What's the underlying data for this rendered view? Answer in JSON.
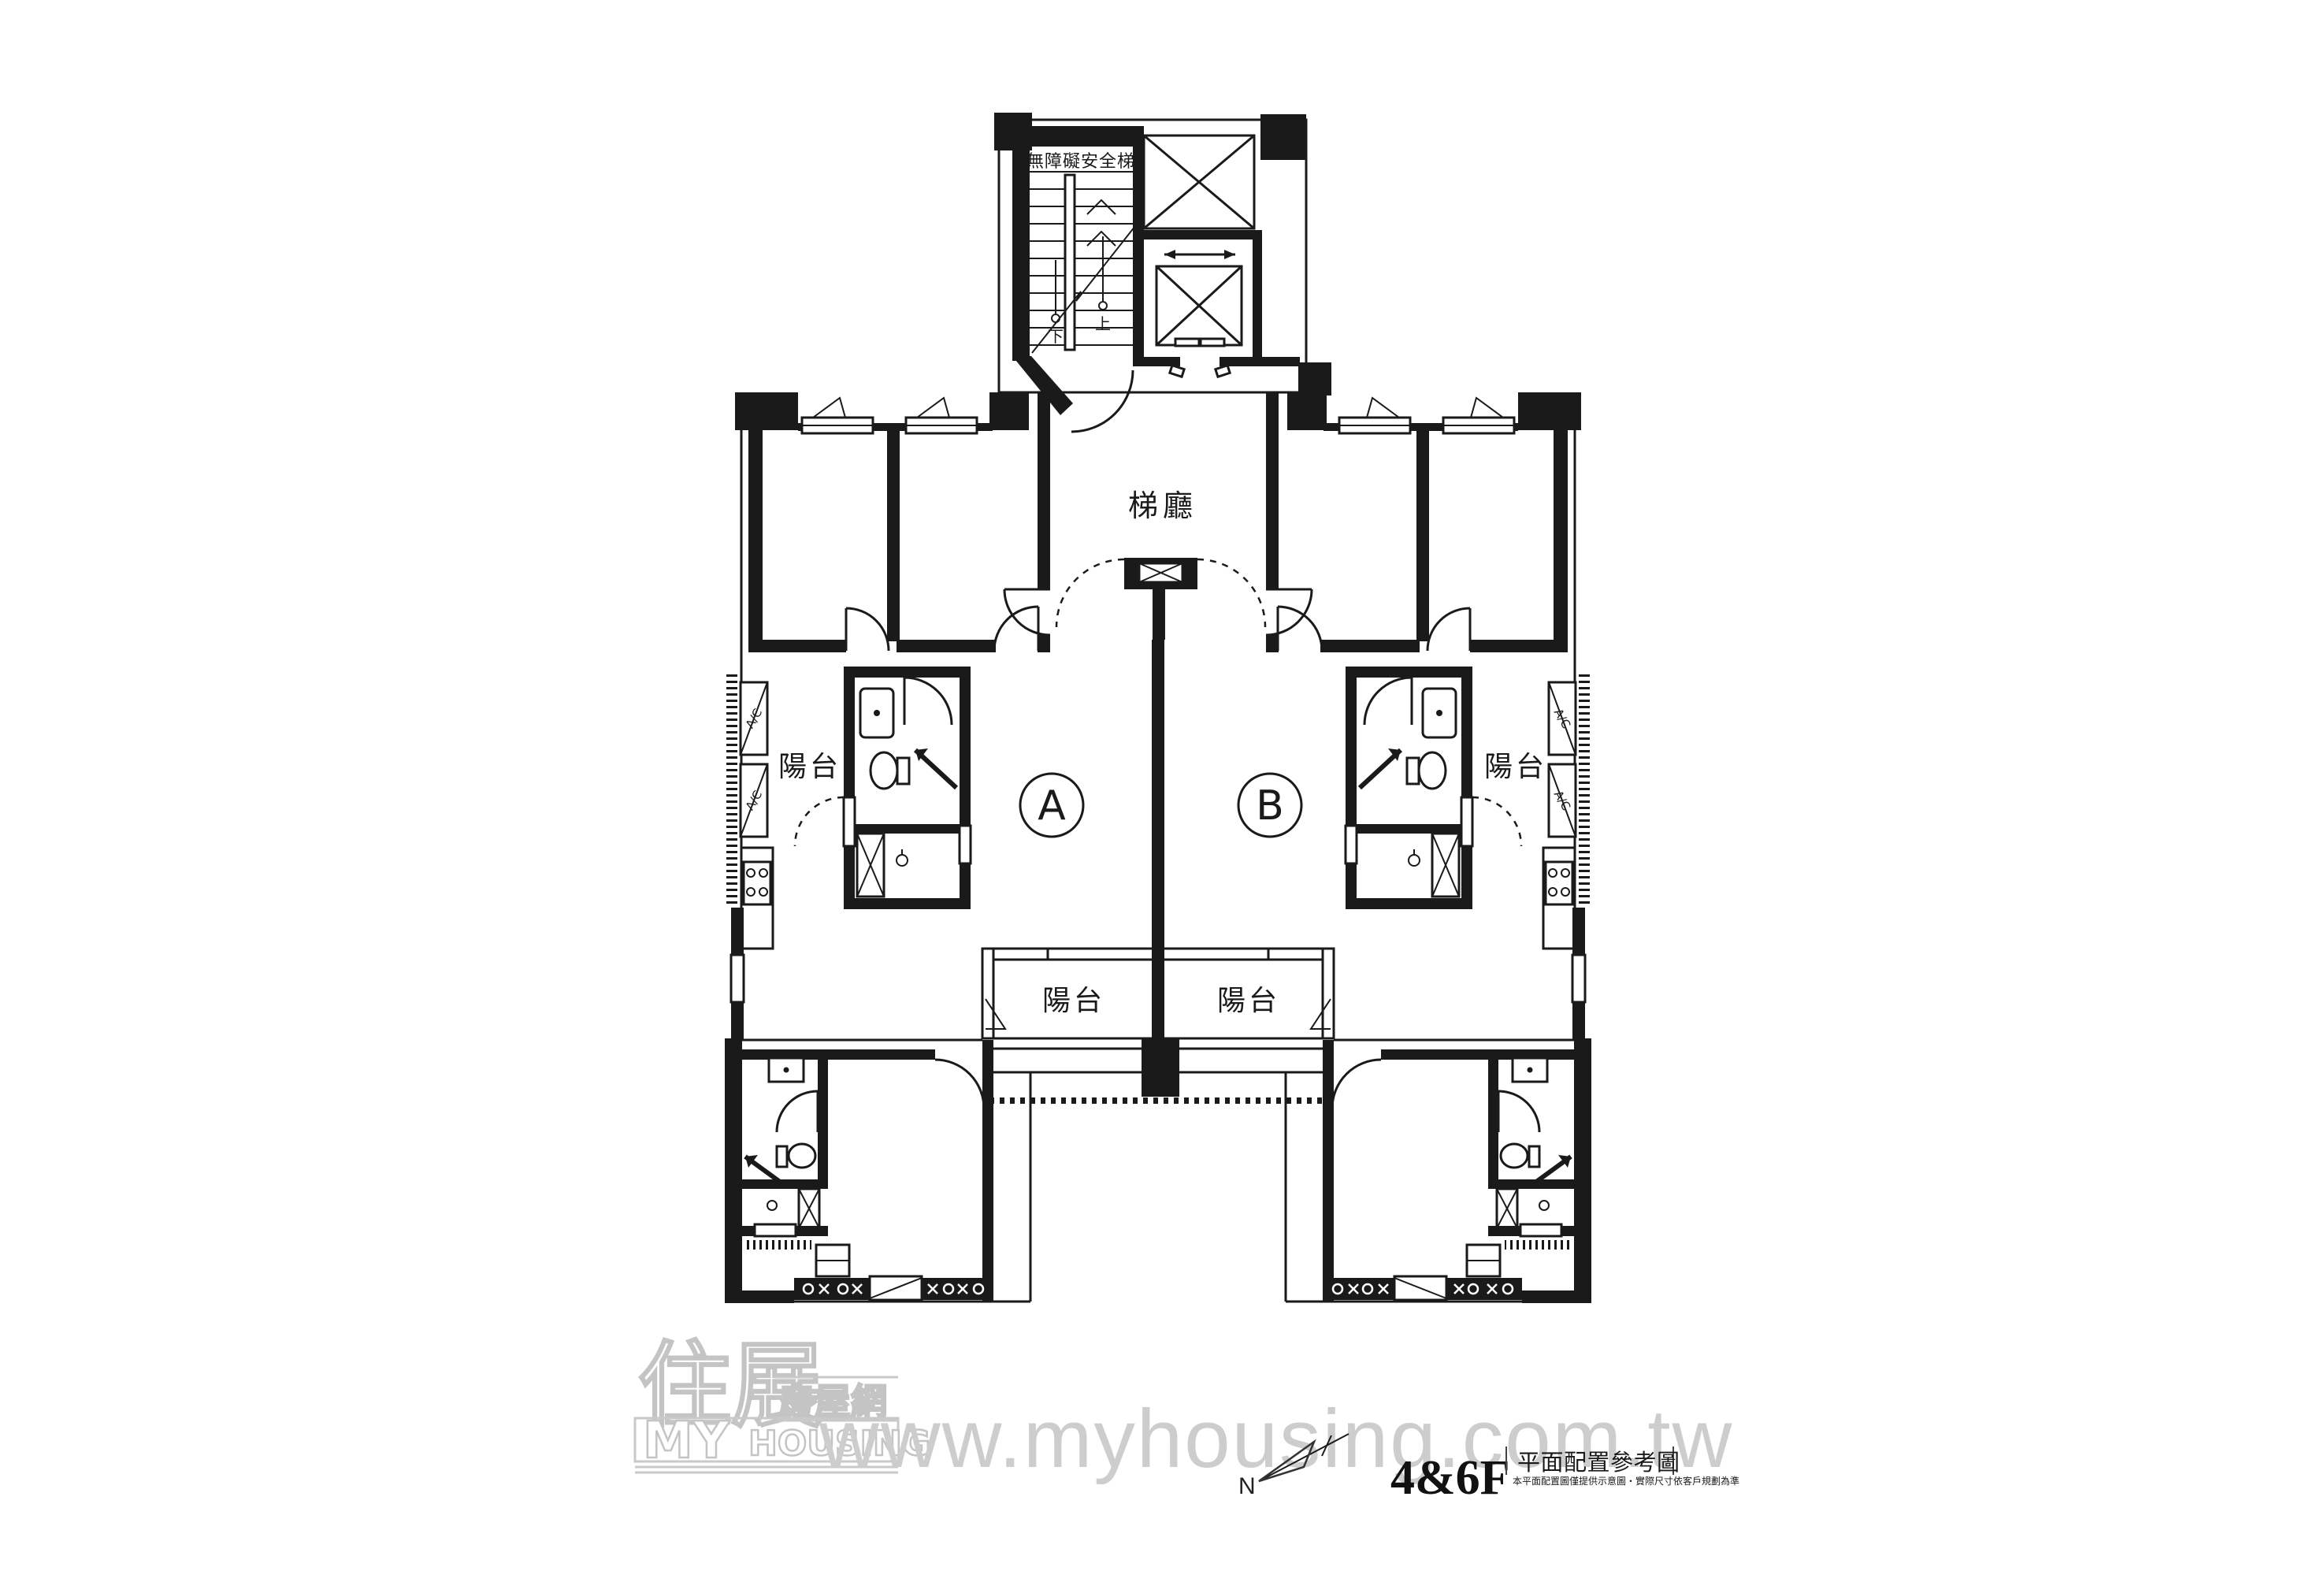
{
  "plan": {
    "stair": {
      "label": "無障礙安全梯",
      "up": "上",
      "down": "下"
    },
    "lobby": {
      "label": "梯廳"
    },
    "units": {
      "a": "A",
      "b": "B"
    },
    "balconies": {
      "left": "陽台",
      "right": "陽台",
      "bottom_left": "陽台",
      "bottom_right": "陽台"
    },
    "ac": "A/C"
  },
  "footer": {
    "north": "N",
    "logo": {
      "brand_zh": "住展",
      "sub_zh": "房屋網",
      "en_1": "MY",
      "en_2": "HOUSING"
    },
    "watermark": "www.myhousing.com.tw",
    "floor": "4&6F",
    "title": "平面配置參考圖",
    "disclaimer": "本平面配置圖僅提供示意圖・實際尺寸依客戶規劃為準"
  },
  "colors": {
    "wall": "#1a1a1a",
    "background": "#ffffff",
    "watermark_gray": "#cdcdcd",
    "logo_gray": "#c9c9c9"
  }
}
